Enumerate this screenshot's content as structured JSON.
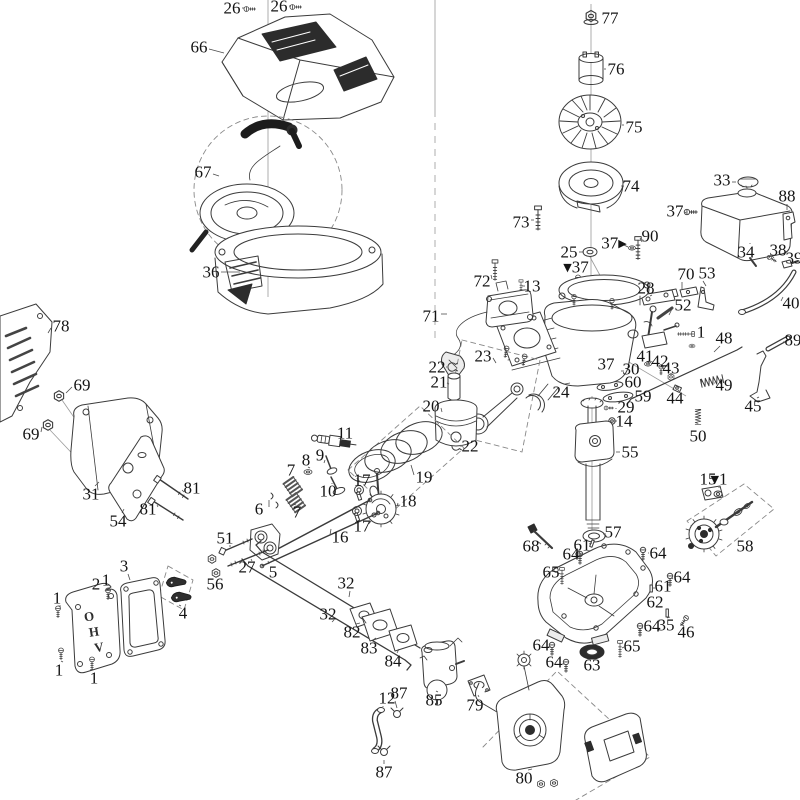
{
  "diagram": {
    "description": "exploded-parts-diagram-small-ohv-engine",
    "canvas": {
      "width": 800,
      "height": 800
    },
    "colors": {
      "background": "#ffffff",
      "line": "#3b3b3b",
      "label": "#141414"
    },
    "embossed_text": "OHV",
    "labels": [
      {
        "t": "26",
        "x": 232,
        "y": 8,
        "lx": 244,
        "ly": 8
      },
      {
        "t": "26",
        "x": 279,
        "y": 6,
        "lx": 291,
        "ly": 6
      },
      {
        "t": "66",
        "x": 199,
        "y": 47,
        "lx": 224,
        "ly": 53
      },
      {
        "t": "67",
        "x": 203,
        "y": 172,
        "lx": 219,
        "ly": 176
      },
      {
        "t": "36",
        "x": 211,
        "y": 272,
        "lx": 240,
        "ly": 272
      },
      {
        "t": "77",
        "x": 610,
        "y": 18,
        "lx": 600,
        "ly": 18
      },
      {
        "t": "76",
        "x": 616,
        "y": 69,
        "lx": 604,
        "ly": 69
      },
      {
        "t": "75",
        "x": 634,
        "y": 127,
        "lx": 622,
        "ly": 125
      },
      {
        "t": "74",
        "x": 631,
        "y": 186,
        "lx": 624,
        "ly": 186
      },
      {
        "t": "73",
        "x": 521,
        "y": 222,
        "lx": 534,
        "ly": 220
      },
      {
        "t": "90",
        "x": 650,
        "y": 236,
        "lx": 642,
        "ly": 242
      },
      {
        "t": "25",
        "x": 569,
        "y": 252,
        "lx": 584,
        "ly": 252
      },
      {
        "t": "▾37",
        "x": 576,
        "y": 267
      },
      {
        "t": "37▸",
        "x": 614,
        "y": 243,
        "lx": 628,
        "ly": 247
      },
      {
        "t": "72",
        "x": 482,
        "y": 281,
        "lx": 491,
        "ly": 275
      },
      {
        "t": "13",
        "x": 532,
        "y": 286,
        "lx": 525,
        "ly": 286
      },
      {
        "t": "71",
        "x": 431,
        "y": 316,
        "lx": 447,
        "ly": 314
      },
      {
        "t": "33",
        "x": 722,
        "y": 180,
        "lx": 736,
        "ly": 182
      },
      {
        "t": "37",
        "x": 675,
        "y": 211,
        "lx": 686,
        "ly": 212
      },
      {
        "t": "88",
        "x": 787,
        "y": 196,
        "lx": 787,
        "ly": 210
      },
      {
        "t": "34",
        "x": 746,
        "y": 252,
        "lx": 750,
        "ly": 243
      },
      {
        "t": "38",
        "x": 778,
        "y": 250,
        "lx": 772,
        "ly": 256
      },
      {
        "t": "39",
        "x": 794,
        "y": 258
      },
      {
        "t": "40",
        "x": 791,
        "y": 303,
        "lx": 783,
        "ly": 297
      },
      {
        "t": "53",
        "x": 707,
        "y": 273,
        "lx": 706,
        "ly": 286
      },
      {
        "t": "70",
        "x": 686,
        "y": 274,
        "lx": 682,
        "ly": 289
      },
      {
        "t": "28",
        "x": 646,
        "y": 288,
        "lx": 652,
        "ly": 295
      },
      {
        "t": "52",
        "x": 683,
        "y": 305,
        "lx": 669,
        "ly": 315
      },
      {
        "t": "1",
        "x": 701,
        "y": 332,
        "lx": 694,
        "ly": 334
      },
      {
        "t": "48",
        "x": 724,
        "y": 338,
        "lx": 714,
        "ly": 352
      },
      {
        "t": "89",
        "x": 793,
        "y": 340,
        "lx": 786,
        "ly": 342
      },
      {
        "t": "41",
        "x": 645,
        "y": 356,
        "lx": 648,
        "ly": 361
      },
      {
        "t": "42",
        "x": 660,
        "y": 361,
        "lx": 661,
        "ly": 366
      },
      {
        "t": "43",
        "x": 671,
        "y": 368,
        "lx": 671,
        "ly": 373
      },
      {
        "t": "44",
        "x": 675,
        "y": 398,
        "lx": 677,
        "ly": 392
      },
      {
        "t": "30",
        "x": 631,
        "y": 369,
        "lx": 624,
        "ly": 371
      },
      {
        "t": "60",
        "x": 633,
        "y": 382,
        "lx": 622,
        "ly": 385
      },
      {
        "t": "59",
        "x": 643,
        "y": 396,
        "lx": 633,
        "ly": 397
      },
      {
        "t": "29",
        "x": 626,
        "y": 407,
        "lx": 616,
        "ly": 408
      },
      {
        "t": "14",
        "x": 624,
        "y": 421,
        "lx": 617,
        "ly": 421
      },
      {
        "t": "49",
        "x": 724,
        "y": 385,
        "lx": 715,
        "ly": 383
      },
      {
        "t": "45",
        "x": 753,
        "y": 406,
        "lx": 759,
        "ly": 397
      },
      {
        "t": "50",
        "x": 698,
        "y": 436,
        "lx": 698,
        "ly": 428
      },
      {
        "t": "37",
        "x": 606,
        "y": 364
      },
      {
        "t": "24",
        "x": 561,
        "y": 392,
        "lx": 570,
        "ly": 383
      },
      {
        "t": "55",
        "x": 630,
        "y": 452,
        "lx": 616,
        "ly": 452
      },
      {
        "t": "78",
        "x": 61,
        "y": 326,
        "lx": 48,
        "ly": 333
      },
      {
        "t": "69",
        "x": 82,
        "y": 385,
        "lx": 66,
        "ly": 393
      },
      {
        "t": "69",
        "x": 31,
        "y": 434,
        "lx": 42,
        "ly": 427
      },
      {
        "t": "31",
        "x": 91,
        "y": 494,
        "lx": 99,
        "ly": 482
      },
      {
        "t": "54",
        "x": 118,
        "y": 521,
        "lx": 124,
        "ly": 509
      },
      {
        "t": "81",
        "x": 192,
        "y": 488,
        "lx": 184,
        "ly": 492
      },
      {
        "t": "81",
        "x": 148,
        "y": 509,
        "lx": 157,
        "ly": 505
      },
      {
        "t": "11",
        "x": 345,
        "y": 433,
        "lx": 341,
        "ly": 440
      },
      {
        "t": "9",
        "x": 320,
        "y": 455,
        "lx": 325,
        "ly": 460
      },
      {
        "t": "8",
        "x": 306,
        "y": 460,
        "lx": 308,
        "ly": 467
      },
      {
        "t": "7",
        "x": 291,
        "y": 470,
        "lx": 291,
        "ly": 478
      },
      {
        "t": "7",
        "x": 297,
        "y": 512,
        "lx": 296,
        "ly": 505
      },
      {
        "t": "10",
        "x": 328,
        "y": 491,
        "lx": 332,
        "ly": 484
      },
      {
        "t": "6",
        "x": 259,
        "y": 509,
        "lx": 269,
        "ly": 500
      },
      {
        "t": "17",
        "x": 362,
        "y": 480,
        "lx": 360,
        "ly": 488
      },
      {
        "t": "17",
        "x": 362,
        "y": 526,
        "lx": 359,
        "ly": 517
      },
      {
        "t": "18",
        "x": 408,
        "y": 501,
        "lx": 397,
        "ly": 506
      },
      {
        "t": "16",
        "x": 340,
        "y": 537,
        "lx": 331,
        "ly": 529
      },
      {
        "t": "19",
        "x": 424,
        "y": 477,
        "lx": 411,
        "ly": 465
      },
      {
        "t": "20",
        "x": 431,
        "y": 406,
        "lx": 442,
        "ly": 412
      },
      {
        "t": "22",
        "x": 437,
        "y": 367,
        "lx": 446,
        "ly": 367
      },
      {
        "t": "21",
        "x": 439,
        "y": 382,
        "lx": 447,
        "ly": 383
      },
      {
        "t": "22",
        "x": 470,
        "y": 446,
        "lx": 462,
        "ly": 446
      },
      {
        "t": "23",
        "x": 483,
        "y": 356,
        "lx": 496,
        "ly": 363
      },
      {
        "t": "51",
        "x": 225,
        "y": 538,
        "lx": 231,
        "ly": 546
      },
      {
        "t": "27",
        "x": 247,
        "y": 567,
        "lx": 252,
        "ly": 561
      },
      {
        "t": "56",
        "x": 215,
        "y": 584,
        "lx": 216,
        "ly": 577
      },
      {
        "t": "5",
        "x": 273,
        "y": 572,
        "lx": 268,
        "ly": 561
      },
      {
        "t": "4",
        "x": 183,
        "y": 613,
        "lx": 181,
        "ly": 606
      },
      {
        "t": "2",
        "x": 96,
        "y": 584,
        "lx": 100,
        "ly": 592
      },
      {
        "t": "1",
        "x": 106,
        "y": 580,
        "lx": 108,
        "ly": 588
      },
      {
        "t": "3",
        "x": 124,
        "y": 566,
        "lx": 130,
        "ly": 580
      },
      {
        "t": "1",
        "x": 57,
        "y": 598,
        "lx": 58,
        "ly": 606
      },
      {
        "t": "1",
        "x": 59,
        "y": 670,
        "lx": 61,
        "ly": 661
      },
      {
        "t": "1",
        "x": 94,
        "y": 678,
        "lx": 93,
        "ly": 669
      },
      {
        "t": "32",
        "x": 346,
        "y": 583,
        "lx": 349,
        "ly": 597
      },
      {
        "t": "32",
        "x": 328,
        "y": 614,
        "lx": 334,
        "ly": 620
      },
      {
        "t": "82",
        "x": 352,
        "y": 632,
        "lx": 360,
        "ly": 623
      },
      {
        "t": "83",
        "x": 369,
        "y": 648,
        "lx": 376,
        "ly": 638
      },
      {
        "t": "84",
        "x": 393,
        "y": 661,
        "lx": 399,
        "ly": 649
      },
      {
        "t": "85",
        "x": 434,
        "y": 700,
        "lx": 436,
        "ly": 691
      },
      {
        "t": "79",
        "x": 475,
        "y": 705,
        "lx": 478,
        "ly": 695
      },
      {
        "t": "12",
        "x": 387,
        "y": 698,
        "lx": 383,
        "ly": 707
      },
      {
        "t": "87",
        "x": 399,
        "y": 693,
        "lx": 397,
        "ly": 708
      },
      {
        "t": "87",
        "x": 384,
        "y": 772,
        "lx": 384,
        "ly": 760
      },
      {
        "t": "80",
        "x": 524,
        "y": 778,
        "lx": 532,
        "ly": 769
      },
      {
        "t": "57",
        "x": 613,
        "y": 532,
        "lx": 606,
        "ly": 534
      },
      {
        "t": "68",
        "x": 531,
        "y": 546,
        "lx": 537,
        "ly": 541
      },
      {
        "t": "61",
        "x": 582,
        "y": 545,
        "lx": 589,
        "ly": 544
      },
      {
        "t": "64",
        "x": 571,
        "y": 554,
        "lx": 578,
        "ly": 556
      },
      {
        "t": "64",
        "x": 658,
        "y": 553,
        "lx": 649,
        "ly": 553
      },
      {
        "t": "65",
        "x": 551,
        "y": 572,
        "lx": 558,
        "ly": 573
      },
      {
        "t": "64",
        "x": 682,
        "y": 577,
        "lx": 673,
        "ly": 578
      },
      {
        "t": "61",
        "x": 663,
        "y": 586,
        "lx": 655,
        "ly": 588
      },
      {
        "t": "62",
        "x": 655,
        "y": 602,
        "lx": 645,
        "ly": 602
      },
      {
        "t": "64",
        "x": 652,
        "y": 626,
        "lx": 643,
        "ly": 628
      },
      {
        "t": "35",
        "x": 666,
        "y": 625,
        "lx": 667,
        "ly": 618
      },
      {
        "t": "46",
        "x": 686,
        "y": 632,
        "lx": 684,
        "ly": 626
      },
      {
        "t": "65",
        "x": 632,
        "y": 646,
        "lx": 624,
        "ly": 647
      },
      {
        "t": "64",
        "x": 541,
        "y": 645,
        "lx": 548,
        "ly": 647
      },
      {
        "t": "64",
        "x": 554,
        "y": 662,
        "lx": 562,
        "ly": 664
      },
      {
        "t": "63",
        "x": 592,
        "y": 665
      },
      {
        "t": "15",
        "x": 708,
        "y": 479,
        "lx": 708,
        "ly": 487
      },
      {
        "t": "▾1",
        "x": 719,
        "y": 479,
        "lx": 719,
        "ly": 488
      },
      {
        "t": "58",
        "x": 745,
        "y": 546
      }
    ]
  }
}
